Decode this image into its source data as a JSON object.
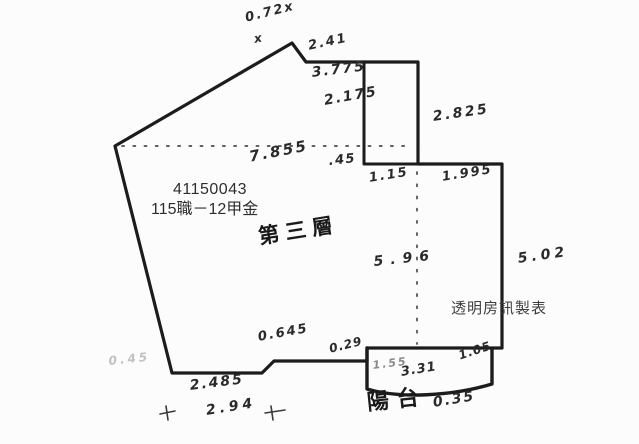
{
  "plan": {
    "colors": {
      "ink": "#1c1c1c",
      "paper": "#fcfcfc",
      "watermark": "#3d3d3d"
    },
    "parcel_number": "41150043",
    "parcel_name": "115職－12甲金",
    "floor_label": "第三層",
    "balcony_label": "陽台",
    "publisher_watermark": "透明房訊製表",
    "dims": {
      "top_offset": "0.72x",
      "x_mark": "x",
      "top_edge": "2.41",
      "upper_inner_a": "3.775",
      "upper_inner_b": "2.175",
      "shaft_side": "2.825",
      "shaft_gap": ".45",
      "shaft_width": "1.15",
      "right_shoulder": "1.995",
      "interior_width": "7.855",
      "interior_depth": "5.96",
      "right_side": "5.02",
      "step_left": "0.645",
      "step_right": "0.29",
      "faint_left": "0.45",
      "bottom_edge": "2.485",
      "bottom_span": "2.94",
      "balcony_seg_left": "1.55",
      "balcony_width": "3.31",
      "balcony_seg_right": "1.05",
      "balcony_depth": "0.35"
    }
  }
}
